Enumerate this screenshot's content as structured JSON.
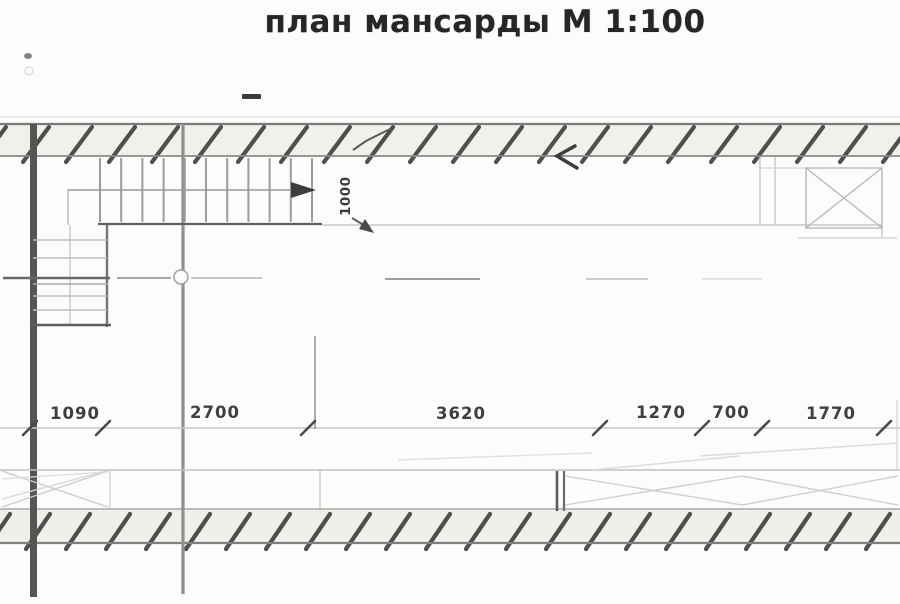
{
  "title": {
    "text": "план мансарды М 1:100"
  },
  "dimensions": {
    "horizontal": [
      {
        "label": "1090"
      },
      {
        "label": "2700"
      },
      {
        "label": "3620"
      },
      {
        "label": "1270"
      },
      {
        "label": "700"
      },
      {
        "label": "1770"
      }
    ],
    "vertical": [
      {
        "label": "1000"
      }
    ]
  },
  "colors": {
    "paper": "#fcfcfa",
    "ink_dark": "#3c3c3a",
    "line_medium": "#8a8a88",
    "line_light": "#c6c6c4",
    "hatch": "#4f4f4d"
  }
}
